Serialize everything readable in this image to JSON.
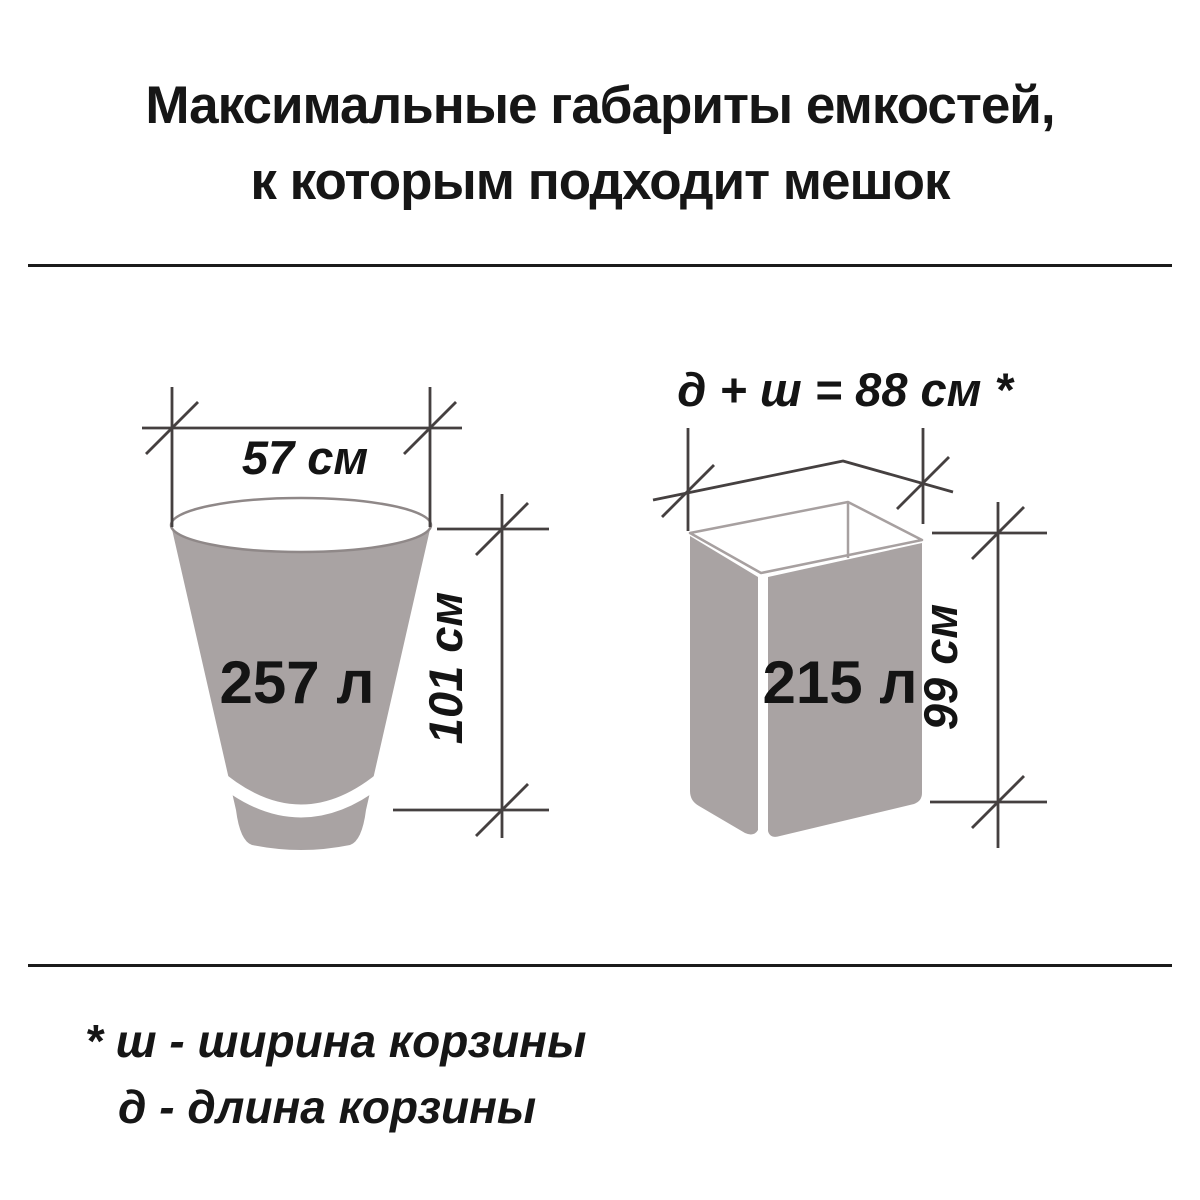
{
  "title": {
    "line1": "Максимальные габариты емкостей,",
    "line2": "к которым подходит мешок"
  },
  "diagrams": {
    "bucket": {
      "volume_label": "257 л",
      "width_label": "57 см",
      "height_label": "101 см"
    },
    "basket": {
      "volume_label": "215 л",
      "width_label": "д + ш = 88 см *",
      "height_label": "99 см"
    }
  },
  "footnote": {
    "line1": "* ш - ширина корзины",
    "line2": "д - длина корзины"
  },
  "colors": {
    "container_fill": "#a9a3a3",
    "dimension_line": "#454040",
    "bucket_rim_stroke": "#8f8888",
    "basket_rim_stroke": "#a7a0a0",
    "divider": "#1b1b1b",
    "text": "#161616"
  }
}
